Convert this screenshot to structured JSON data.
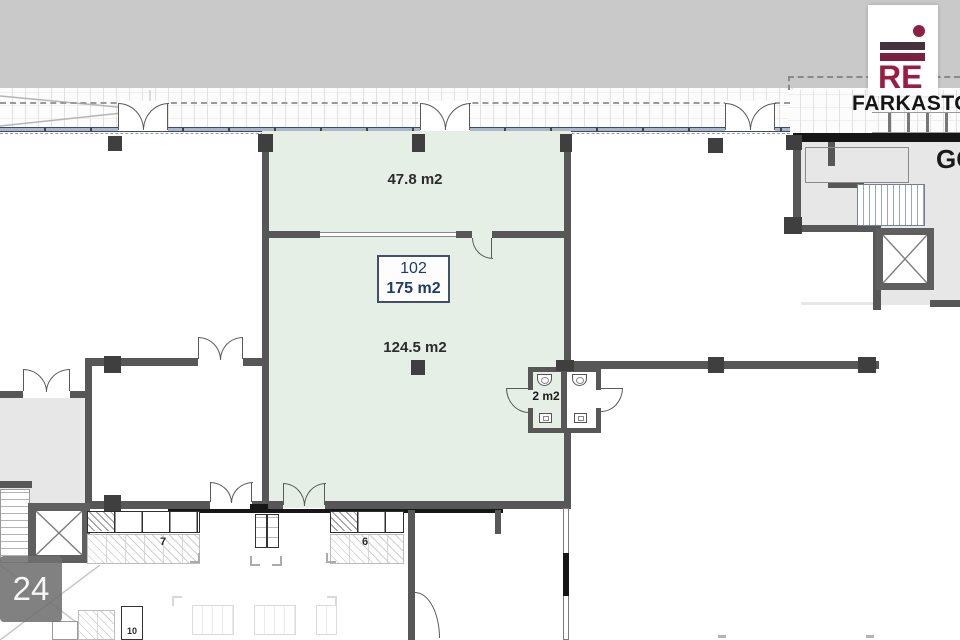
{
  "branding": {
    "logo_text": "RE",
    "brand_color": "#9a1c45",
    "watermark_text": "FARKASTOM",
    "edge_text": "GO"
  },
  "plan": {
    "unit": {
      "number": "102",
      "total_area": "175 m2"
    },
    "rooms": [
      {
        "name": "upper-room",
        "area": "47.8 m2"
      },
      {
        "name": "main-room",
        "area": "124.5 m2"
      },
      {
        "name": "wc",
        "area": "2 m2"
      }
    ],
    "furniture_labels": [
      "7",
      "6",
      "10"
    ],
    "page_number": "24",
    "colors": {
      "unit_fill": "#e6efe6",
      "wall": "#575757",
      "floor_fill": "#e7e7e7",
      "label_text": "#1e3a6e"
    }
  }
}
